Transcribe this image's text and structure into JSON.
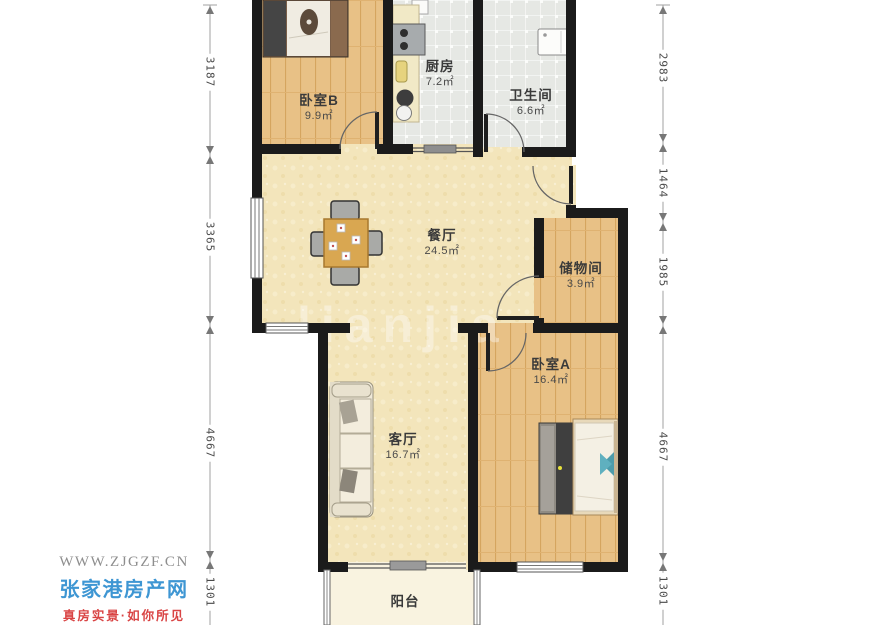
{
  "watermark": {
    "text": "lianjia"
  },
  "branding": {
    "url": "WWW.ZJGZF.CN",
    "site_name": "张家港房产网",
    "slogan": "真房实景·如你所见"
  },
  "rooms": [
    {
      "name": "卧室B",
      "area": "9.9㎡"
    },
    {
      "name": "厨房",
      "area": "7.2㎡"
    },
    {
      "name": "卫生间",
      "area": "6.6㎡"
    },
    {
      "name": "餐厅",
      "area": "24.5㎡"
    },
    {
      "name": "储物间",
      "area": "3.9㎡"
    },
    {
      "name": "卧室A",
      "area": "16.4㎡"
    },
    {
      "name": "客厅",
      "area": "16.7㎡"
    },
    {
      "name": "阳台",
      "area": ""
    }
  ],
  "dimensions": {
    "left": [
      "3187",
      "3365",
      "4667",
      "1301"
    ],
    "right": [
      "2983",
      "1464",
      "1985",
      "4667",
      "1301"
    ]
  },
  "colors": {
    "wall": "#1b1b1b",
    "floor_main": "#f3e5bb",
    "floor_wood": "#e8c186",
    "floor_tile": "#e6e8e4",
    "floor_balcony": "#f9f3e0",
    "brand_blue": "#3e96d3",
    "brand_red": "#d94444",
    "brand_gray": "#8e8e8e"
  }
}
